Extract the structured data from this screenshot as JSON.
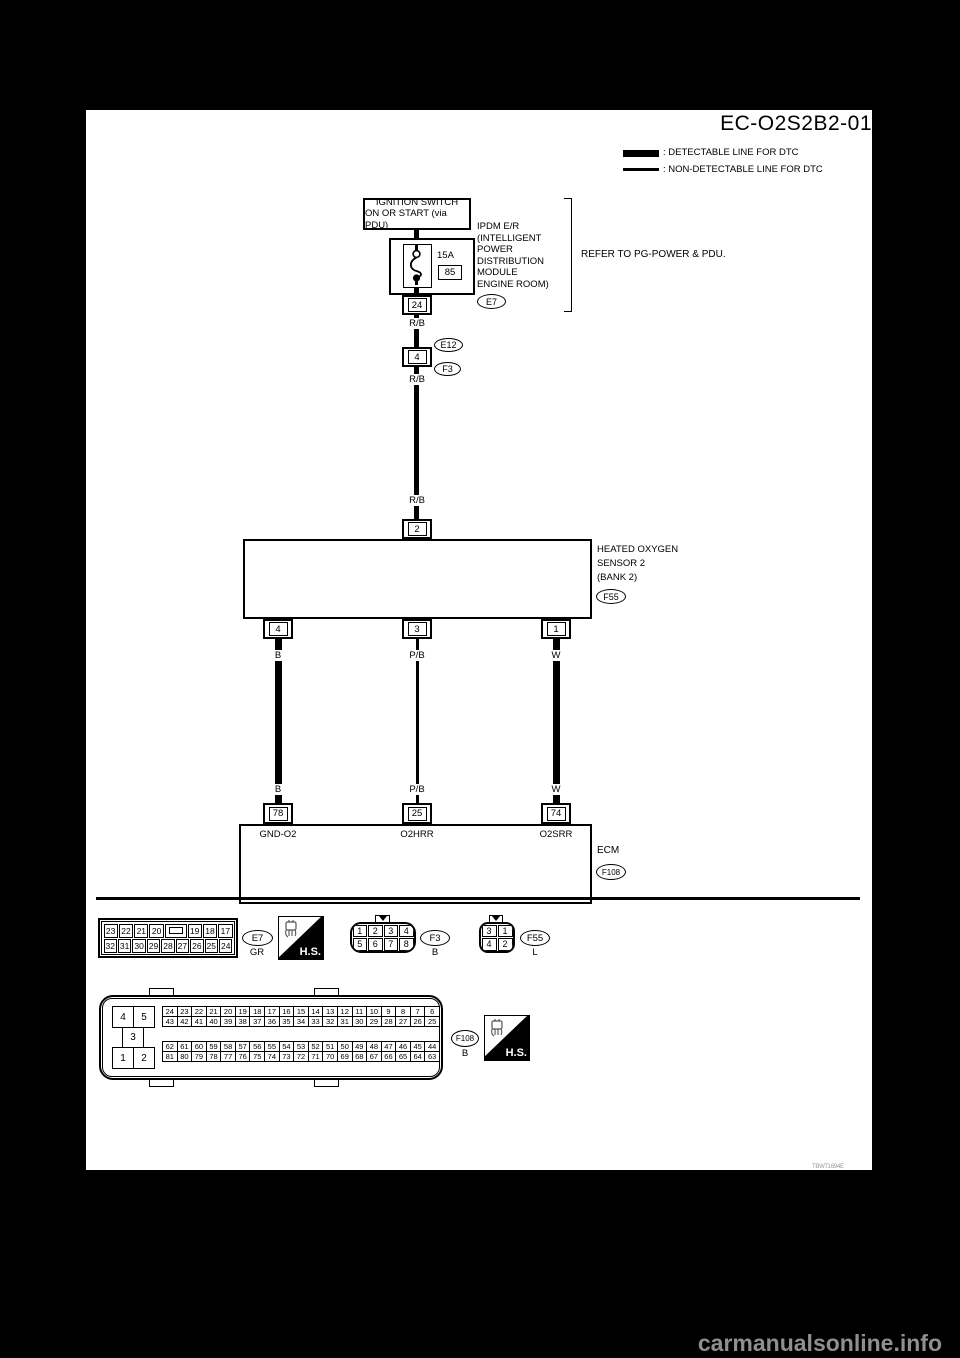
{
  "page": {
    "title": "EC-O2S2B2-01",
    "figure_code": "TBWT1694E",
    "watermark": "carmanualsonline.info"
  },
  "legend": {
    "detectable_label": ": DETECTABLE LINE FOR DTC",
    "non_detectable_label": ": NON-DETECTABLE LINE FOR DTC"
  },
  "power": {
    "ignition_line1": "IGNITION SWITCH",
    "ignition_line2": "ON OR START (via PDU)",
    "fuse_rating": "15A",
    "fuse_number": "85",
    "ipdm_terminal": "24",
    "ipdm_labels": [
      "IPDM E/R",
      "(INTELLIGENT",
      "POWER",
      "DISTRIBUTION",
      "MODULE",
      "ENGINE ROOM)"
    ],
    "ipdm_connector": "E7",
    "refer_note": "REFER TO PG-POWER & PDU.",
    "wire_color": "R/B"
  },
  "joint_connector": {
    "terminal": "4",
    "upper_ref": "E12",
    "lower_ref": "F3"
  },
  "sensor": {
    "terminal_in": "2",
    "name_lines": [
      "HEATED OXYGEN",
      "SENSOR 2",
      "(BANK 2)"
    ],
    "connector_ref": "F55",
    "pins": [
      "4",
      "3",
      "1"
    ],
    "wire_colors": [
      "B",
      "P/B",
      "W"
    ]
  },
  "ecm": {
    "pins": [
      "78",
      "25",
      "74"
    ],
    "signal_names": [
      "GND-O2",
      "O2HRR",
      "O2SRR"
    ],
    "name": "ECM",
    "connector_ref": "F108"
  },
  "connectors": {
    "hs_label": "H.S.",
    "e7": {
      "ref": "E7",
      "color": "GR",
      "rows": [
        [
          "23",
          "22",
          "21",
          "20",
          "",
          "19",
          "18",
          "17"
        ],
        [
          "32",
          "31",
          "30",
          "29",
          "28",
          "27",
          "26",
          "25",
          "24"
        ]
      ]
    },
    "f3": {
      "ref": "F3",
      "color": "B",
      "rows": [
        [
          "1",
          "2",
          "3",
          "4"
        ],
        [
          "5",
          "6",
          "7",
          "8"
        ]
      ]
    },
    "f55": {
      "ref": "F55",
      "color": "L",
      "rows": [
        [
          "3",
          "1"
        ],
        [
          "4",
          "2"
        ]
      ]
    },
    "f108": {
      "ref": "F108",
      "color": "B",
      "left_pins": [
        "4",
        "5",
        "3",
        "1",
        "2"
      ],
      "rows": [
        [
          "24",
          "23",
          "22",
          "21",
          "20",
          "19",
          "18",
          "17",
          "16",
          "15",
          "14",
          "13",
          "12",
          "11",
          "10",
          "9",
          "8",
          "7",
          "6"
        ],
        [
          "43",
          "42",
          "41",
          "40",
          "39",
          "38",
          "37",
          "36",
          "35",
          "34",
          "33",
          "32",
          "31",
          "30",
          "29",
          "28",
          "27",
          "26",
          "25"
        ],
        [
          "62",
          "61",
          "60",
          "59",
          "58",
          "57",
          "56",
          "55",
          "54",
          "53",
          "52",
          "51",
          "50",
          "49",
          "48",
          "47",
          "46",
          "45",
          "44"
        ],
        [
          "81",
          "80",
          "79",
          "78",
          "77",
          "76",
          "75",
          "74",
          "73",
          "72",
          "71",
          "70",
          "69",
          "68",
          "67",
          "66",
          "65",
          "64",
          "63"
        ]
      ]
    }
  }
}
